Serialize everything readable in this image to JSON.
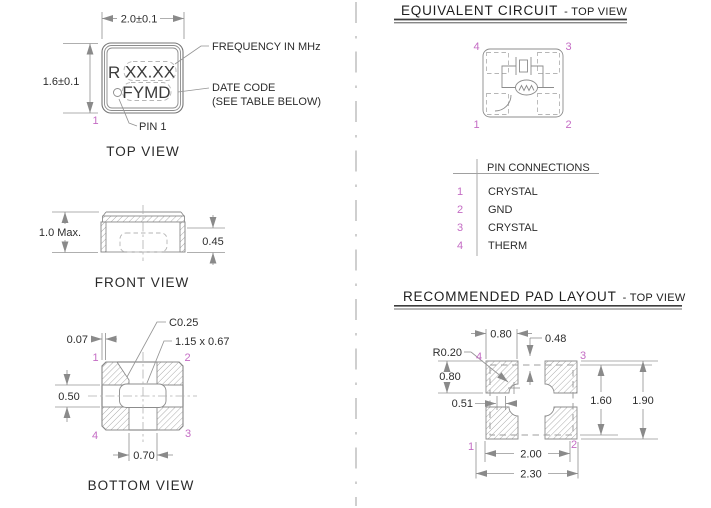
{
  "colors": {
    "pin_number": "#c46cc4",
    "object_line": "#767676",
    "dimension_line": "#949494",
    "text": "#2d2d2d",
    "background": "#ffffff"
  },
  "top_view": {
    "label": "TOP VIEW",
    "dim_width": "2.0±0.1",
    "dim_height": "1.6±0.1",
    "marking_prefix": "R",
    "marking_frequency": "XX.XX",
    "marking_date_code": "FYMD",
    "callout_frequency": "FREQUENCY IN MHz",
    "callout_date_code_line1": "DATE CODE",
    "callout_date_code_line2": "(SEE TABLE BELOW)",
    "callout_pin1": "PIN 1",
    "pin1": "1"
  },
  "front_view": {
    "label": "FRONT VIEW",
    "dim_height_max": "1.0 Max.",
    "dim_terminal_height": "0.45"
  },
  "bottom_view": {
    "label": "BOTTOM VIEW",
    "callout_chamfer": "C0.25",
    "callout_cavity": "1.15 x 0.67",
    "dim_edge_clearance": "0.07",
    "dim_vertical_gap": "0.50",
    "dim_horizontal_gap": "0.70",
    "pins": {
      "p1": "1",
      "p2": "2",
      "p3": "3",
      "p4": "4"
    }
  },
  "equivalent_circuit": {
    "title": "EQUIVALENT CIRCUIT",
    "title_suffix": "- TOP VIEW",
    "pins": {
      "p1": "1",
      "p2": "2",
      "p3": "3",
      "p4": "4"
    }
  },
  "pin_connections": {
    "header": "PIN CONNECTIONS",
    "rows": [
      {
        "pin": "1",
        "label": "CRYSTAL"
      },
      {
        "pin": "2",
        "label": "GND"
      },
      {
        "pin": "3",
        "label": "CRYSTAL"
      },
      {
        "pin": "4",
        "label": "THERM"
      }
    ]
  },
  "pad_layout": {
    "title": "RECOMMENDED PAD LAYOUT",
    "title_suffix": "- TOP VIEW",
    "dim_pad_width": "0.80",
    "dim_notch": "0.48",
    "dim_corner_radius": "R0.20",
    "dim_pad_height": "0.80",
    "dim_notch_offset": "0.51",
    "dim_inner_height": "1.60",
    "dim_outer_height": "1.90",
    "dim_inner_width": "2.00",
    "dim_outer_width": "2.30",
    "pins": {
      "p1": "1",
      "p2": "2",
      "p3": "3",
      "p4": "4"
    }
  }
}
